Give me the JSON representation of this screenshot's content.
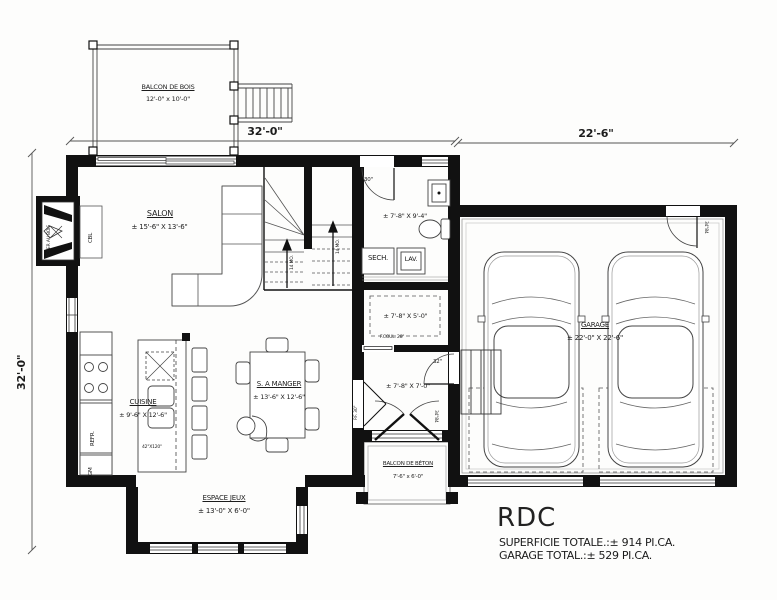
{
  "title_block": {
    "title": "RDC",
    "superficie": "SUPERFICIE TOTALE.:± 914 PI.CA.",
    "garage_total": "GARAGE TOTAL.:± 529 PI.CA."
  },
  "dimensions": {
    "top_left": "32'-0\"",
    "top_right": "22'-6\"",
    "left_side": "32'-0\""
  },
  "rooms": {
    "balcon_bois": {
      "name": "BALCON DE BOIS",
      "size": "12'-0\" x 10'-0\""
    },
    "salon": {
      "name": "SALON",
      "size": "± 15'-6\" X 13'-6\""
    },
    "salle_eau": {
      "size": "± 7'-8\" X 9'-4\""
    },
    "walk_in": {
      "size": "± 7'-8\" X 5'-0\""
    },
    "hall": {
      "size": "± 7'-8\" X 7'-0\""
    },
    "cuisine": {
      "name": "CUISINE",
      "size": "± 9'-6\" X 12'-6\""
    },
    "salle_a_manger": {
      "name": "S. A MANGER",
      "size": "± 13'-6\" X 12'-6\""
    },
    "espace_jeux": {
      "name": "ESPACE JEUX",
      "size": "± 13'-0\" X 6'-0\""
    },
    "garage": {
      "name": "GARAGE",
      "size": "± 22'-0\" X 22'-6\""
    },
    "balcon_beton": {
      "name": "BALCON DE BÉTON",
      "size": "7'-6\" x 6'-0\""
    }
  },
  "appliances": {
    "secheuse": "SECH.",
    "laveuse": "LAV.",
    "refrigerateur": "REFR.",
    "garde_manger": "GM",
    "cable": "CBL",
    "foyer": "FOYER AU BOIS",
    "ilot": "42\"X120\""
  },
  "doors": {
    "bath_door": "30\"",
    "hall_garage_door": "32\"",
    "garage_exterior_door": "34\"84",
    "entry_door": "34\"84",
    "porte_fenetre": "P.F. 30\"",
    "coulissante": "F.COUL. 28\""
  },
  "stairs": {
    "arrow_label": "14 MO."
  }
}
